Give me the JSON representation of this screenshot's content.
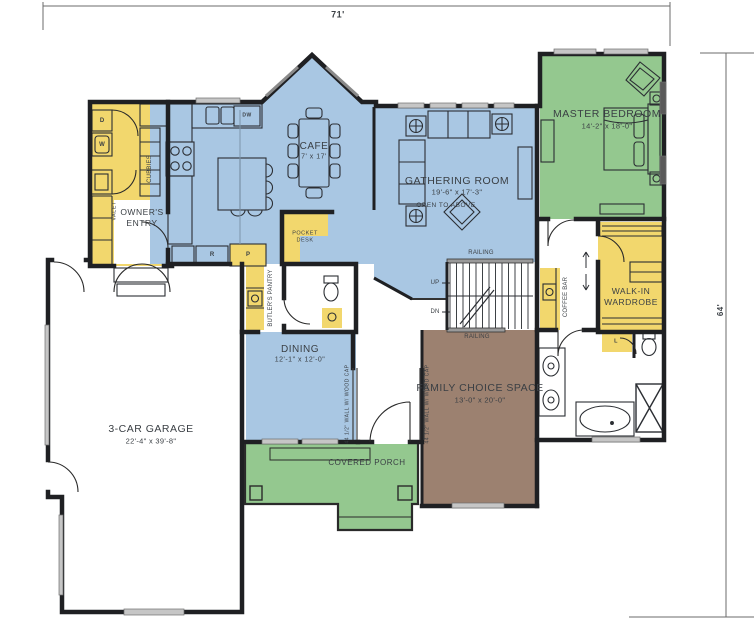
{
  "plan": {
    "dimensions": {
      "width_label": "71'",
      "height_label": "64'"
    },
    "rooms": {
      "garage": {
        "name": "3-CAR GARAGE",
        "dims": "22'-4\" x 39'-8\""
      },
      "cafe": {
        "name": "CAFE",
        "dims": "7' x 17'"
      },
      "gathering": {
        "name": "GATHERING ROOM",
        "dims": "19'-6\" x 17'-3\"",
        "note": "OPEN TO ABOVE"
      },
      "master_bedroom": {
        "name": "MASTER BEDROOM",
        "dims": "14'-2\" x 18'-0\""
      },
      "walk_in_wardrobe": {
        "line1": "WALK-IN",
        "line2": "WARDROBE"
      },
      "dining": {
        "name": "DINING",
        "dims": "12'-1\" x 12'-0\""
      },
      "family_choice": {
        "name": "FAMILY CHOICE SPACE",
        "dims": "13'-0\" x 20'-0\""
      },
      "covered_porch": {
        "name": "COVERED PORCH"
      },
      "owners_entry": {
        "line1": "OWNER'S",
        "line2": "ENTRY"
      },
      "butlers_pantry": {
        "name": "BUTLER'S PANTRY"
      },
      "coffee_bar": {
        "name": "COFFEE BAR"
      },
      "pocket_desk": {
        "line1": "POCKET",
        "line2": "DESK"
      },
      "cubbies": {
        "name": "CUBBIES"
      },
      "valet": {
        "name": "VALET"
      }
    },
    "stairs": {
      "up": "UP",
      "dn": "DN",
      "railing_top": "RAILING",
      "railing_bottom": "RAILING"
    },
    "appliances": {
      "dryer": "D",
      "washer": "W",
      "refrigerator": "R",
      "pantry": "P",
      "dishwasher": "DW",
      "linen": "L"
    },
    "notes": {
      "wall_cap_left": "44 1/2\" WALL W/ WOOD CAP",
      "wall_cap_right": "44 1/2\" WALL W/ WOOD CAP"
    },
    "colors": {
      "blue": "#a9c7e3",
      "green": "#94c88f",
      "yellow": "#f2d76d",
      "brown": "#9c8170",
      "wall": "#1f2023"
    }
  }
}
